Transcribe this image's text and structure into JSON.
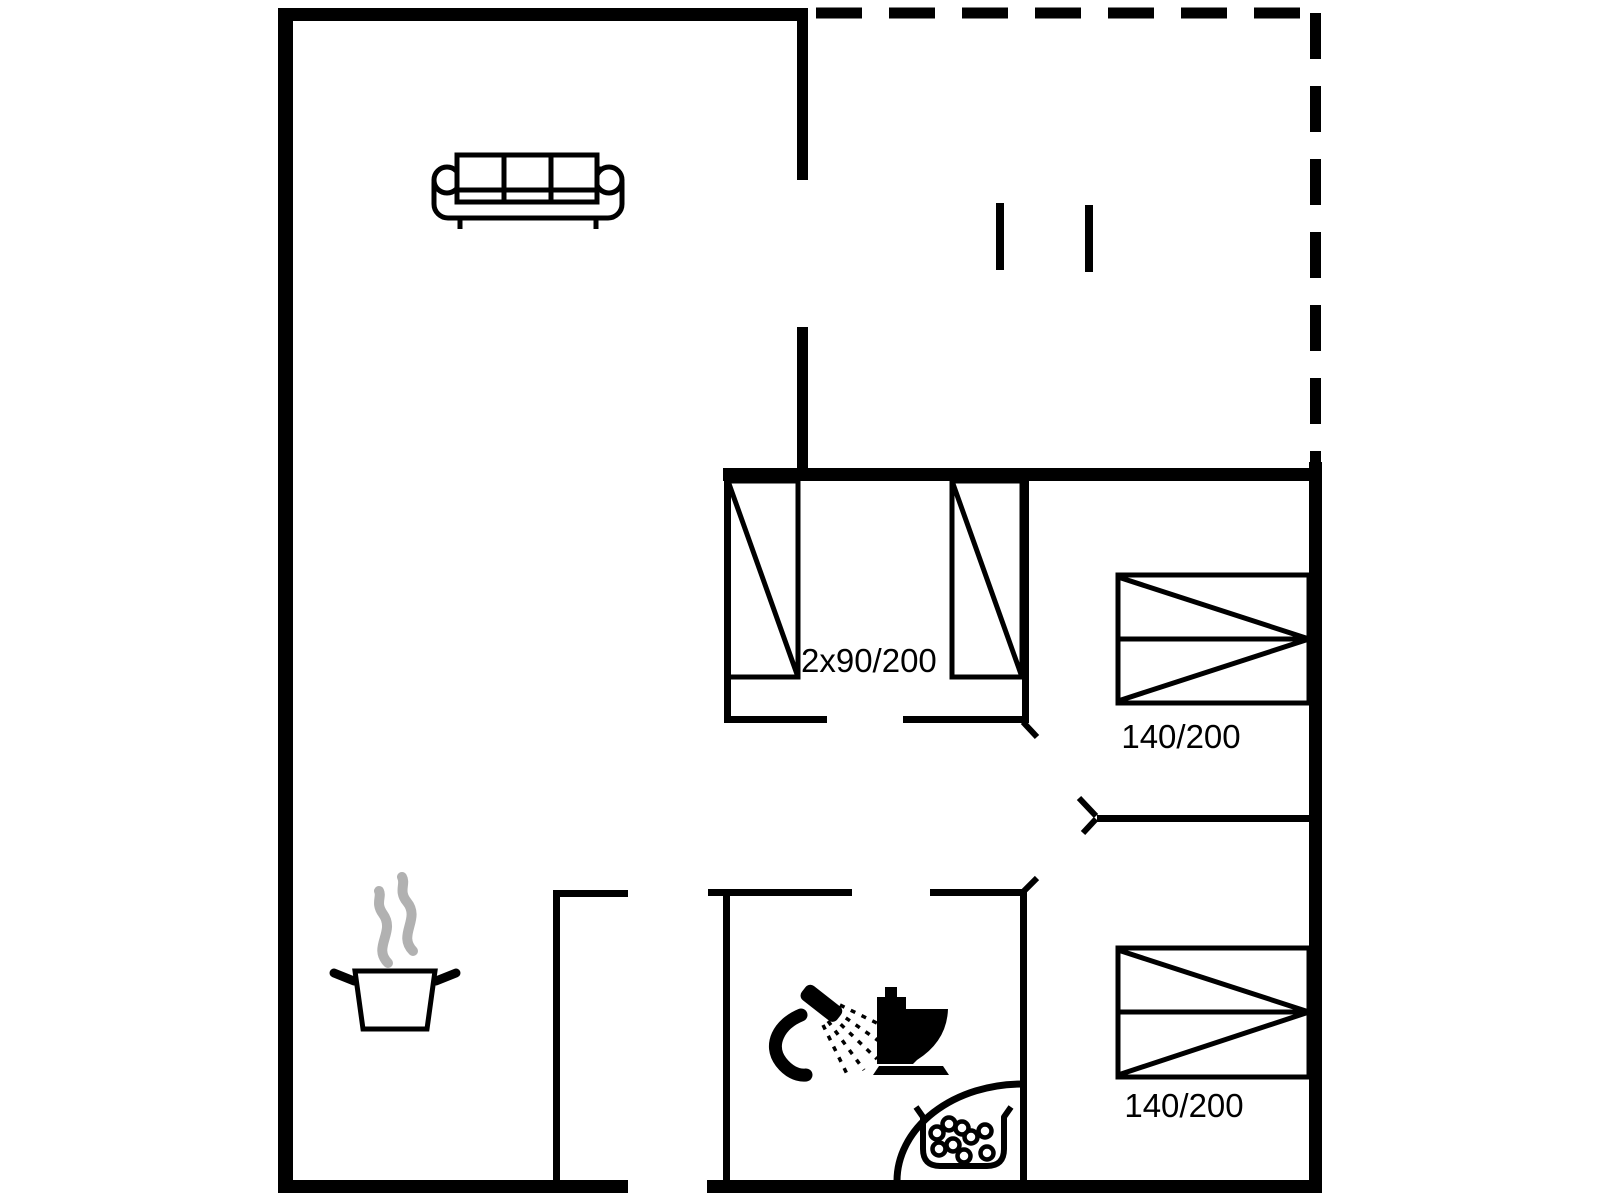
{
  "colors": {
    "line": "#000000",
    "steam": "#b1b1b1",
    "bg": "#ffffff"
  },
  "floorplan": {
    "labels": {
      "wardrobe_beds": "2x90/200",
      "double_bed_top": "140/200",
      "double_bed_bottom": "140/200"
    },
    "icons": [
      "sofa-icon",
      "steam-icon",
      "cooking-pot-icon",
      "shower-icon",
      "toilet-icon",
      "corner-bathtub-icon",
      "terrace-post-icon",
      "door-swing-icon"
    ]
  }
}
